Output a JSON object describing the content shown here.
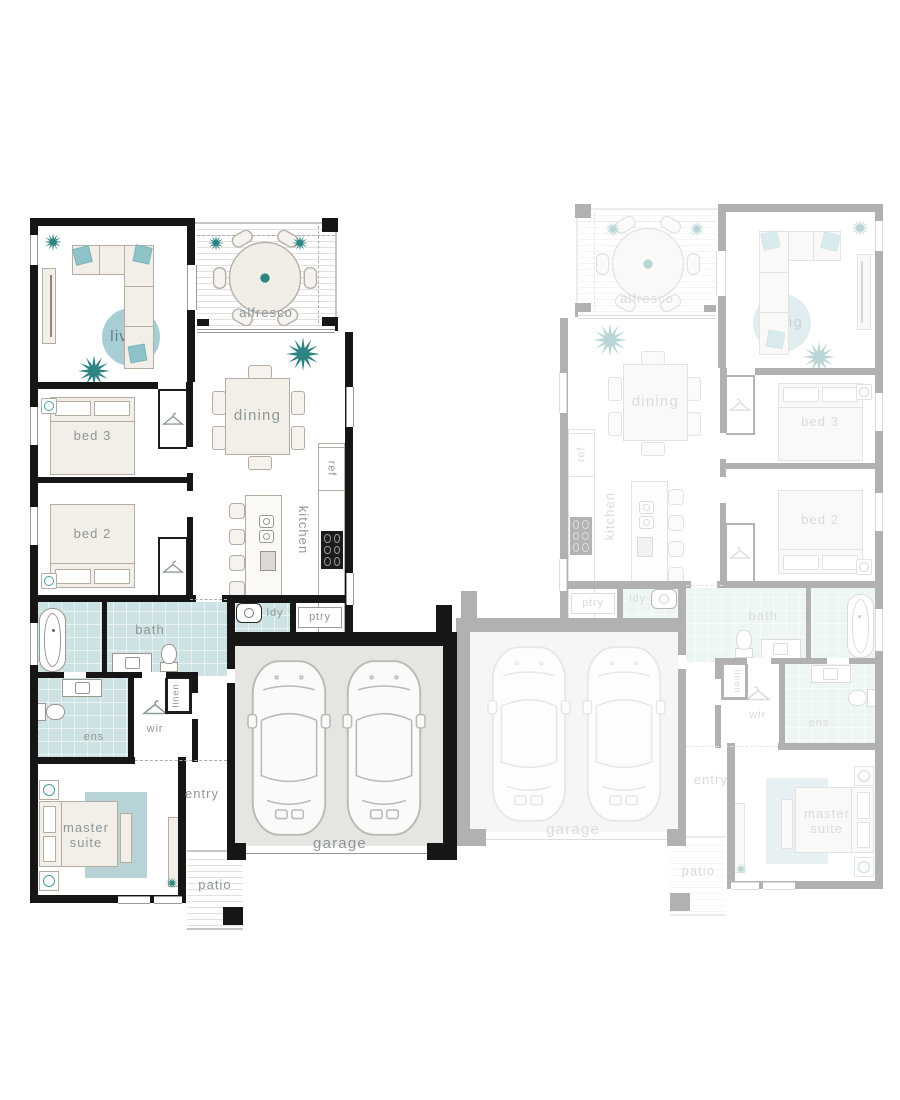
{
  "labels": {
    "living": "living",
    "alfresco": "alfresco",
    "dining": "dining",
    "bed3": "bed 3",
    "bed2": "bed 2",
    "kitchen": "kitchen",
    "ref": "ref",
    "pantry": "ptry",
    "laundry": "ldy",
    "bath": "bath",
    "ensuite": "ens",
    "wir": "wir",
    "linen": "linen",
    "master_line1": "master",
    "master_line2": "suite",
    "entry": "entry",
    "patio": "patio",
    "garage": "garage"
  },
  "palette": {
    "wall": "#161616",
    "line": "#b3ada3",
    "fill": "#f2eee8",
    "rug": "#a6ced4",
    "rug2": "#b7d3d8",
    "accent": "#8fc3ca",
    "plant": "#2e8383",
    "tile": "#cde2e2",
    "stripe": "#e3e1de",
    "garage": "#e7e5e2",
    "labelc": "#8d9797"
  }
}
